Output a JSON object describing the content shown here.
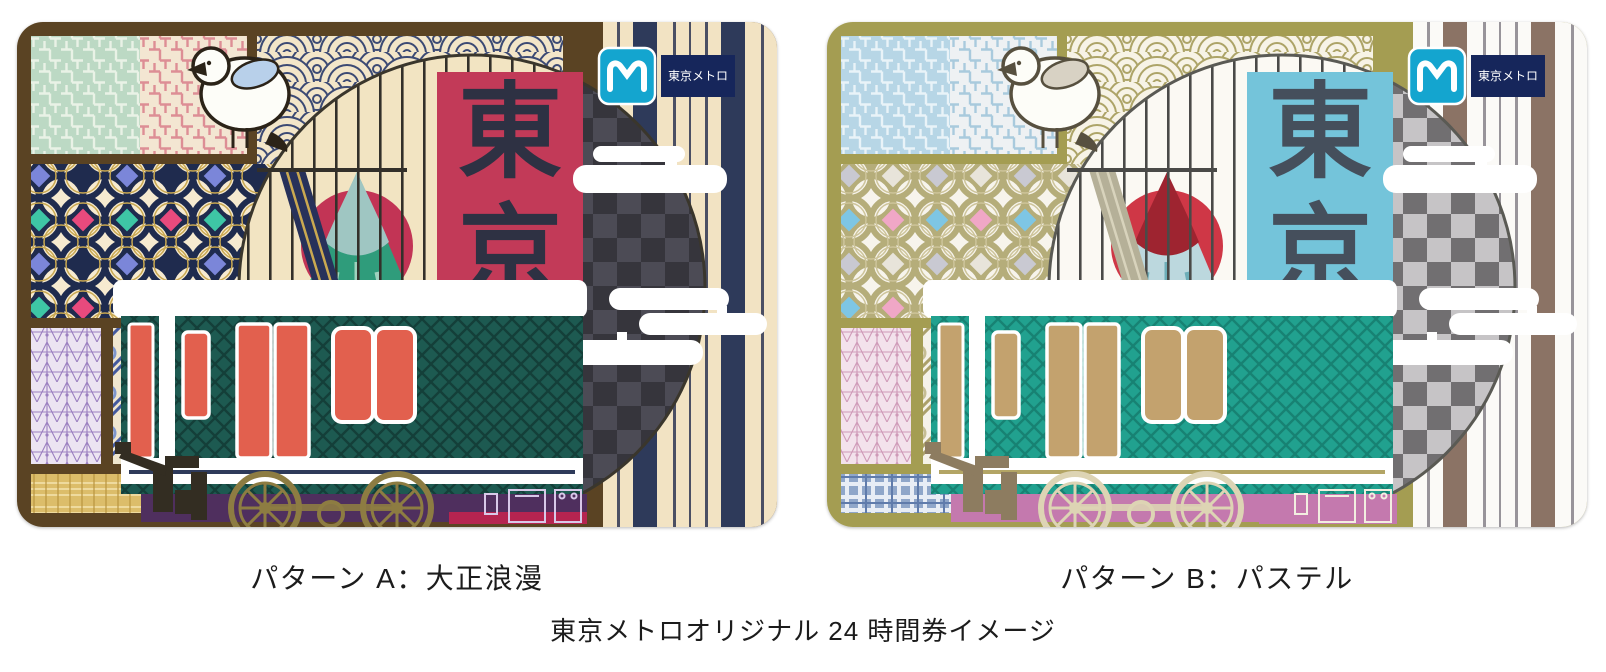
{
  "footer_caption": "東京メトロオリジナル 24 時間券イメージ",
  "cards": [
    {
      "caption": "パターン A：大正浪漫",
      "vertical_label_chars": [
        "東",
        "京"
      ],
      "logo_text": "東京メトロ",
      "palette": {
        "frame": "#5a4323",
        "saya_bg": "#bcd9c4",
        "saya_fg": "#e9f2e6",
        "saya_bg2": "#f3e6d2",
        "saya_fg2": "#dd8e95",
        "wave_bg": "#f3e6c9",
        "wave_fg": "#3c4a74",
        "shippo_bg": "#f6ead0",
        "shippo_ring": "#1f2b4e",
        "shippo_gold": "#c9a851",
        "sh_d1": "#3ec6a5",
        "sh_d2": "#e84a7d",
        "sh_d3": "#7b86d9",
        "sh_d4": "#1f2b4e",
        "asa_bg": "#ece4f2",
        "asa_fg": "#9b7fc0",
        "p2_bg": "#efe6cf",
        "p2_fg": "#43599e",
        "p2_fg2": "#7d95cc",
        "p4_bg": "#dcbd6a",
        "p4_fg": "#eeda9e",
        "p4_dark": "#b9953f",
        "stripe_bg": "#f2e3c3",
        "stripe_a": "#2e3a5a",
        "stripe_b": "#4b4f63",
        "scene_bg": "#f2e4c2",
        "lattice": "#33302a",
        "circle_edge": "#3a362c",
        "check_a": "#36353c",
        "check_b": "#4c4b55",
        "sun": "#c23455",
        "fuji_body": "#2f9c7b",
        "fuji_cap": "#9fc6c2",
        "fuji_streak": "#c5e4d4",
        "panel": "#c23a58",
        "panel_text": "#2e3143",
        "cloud": "#ffffff",
        "train_body": "#1d5a51",
        "train_body2": "#143f39",
        "door": "#e2604e",
        "pinline": "#2e3a5a",
        "under": "#4f2f5e",
        "wheel": "#8d7c42",
        "boxline": "#d8c8e8",
        "accent2": "#b52450",
        "equip": "#332d22",
        "bird_line": "#2b2318",
        "bird_wing": "#b8d0ea",
        "bird_body": "#fdfdf8",
        "logo_cyan": "#14a5cf",
        "logo_navy": "#16265b",
        "beam": "#27315a",
        "beam2": "#c9a851"
      }
    },
    {
      "caption": "パターン B：パステル",
      "vertical_label_chars": [
        "東",
        "京"
      ],
      "logo_text": "東京メトロ",
      "palette": {
        "frame": "#a49d52",
        "saya_bg": "#b7d6e6",
        "saya_fg": "#e9f3f8",
        "saya_bg2": "#eef1f3",
        "saya_fg2": "#a9cadd",
        "wave_bg": "#f7f3e6",
        "wave_fg": "#ada468",
        "shippo_bg": "#f7f4ec",
        "shippo_ring": "#b5ad7a",
        "shippo_gold": "#cdc49a",
        "sh_d1": "#7ec6e4",
        "sh_d2": "#f0a7c6",
        "sh_d3": "#c9c9d2",
        "sh_d4": "#e8e4da",
        "asa_bg": "#f3e2ec",
        "asa_fg": "#cf9ab8",
        "p2_bg": "#f5f2e8",
        "p2_fg": "#aba06a",
        "p2_fg2": "#c5bd92",
        "p4_bg": "#8fa6c9",
        "p4_fg": "#e8edf5",
        "p4_dark": "#5f7bab",
        "stripe_bg": "#fbfaf7",
        "stripe_a": "#8b7365",
        "stripe_b": "#98949a",
        "scene_bg": "#fbf9f3",
        "lattice": "#4a4a48",
        "circle_edge": "#5a5a54",
        "check_a": "#716f71",
        "check_b": "#c6c4c6",
        "sun": "#cf3746",
        "fuji_body": "#bcd8de",
        "fuji_cap": "#9e2430",
        "fuji_streak": "#55a0ac",
        "panel": "#74c4da",
        "panel_text": "#454f5c",
        "cloud": "#ffffff",
        "train_body": "#21a18f",
        "train_body2": "#178273",
        "door": "#c3a26e",
        "pinline": "#b3a565",
        "under": "#c479ae",
        "wheel": "#ddd4b4",
        "boxline": "#f2eee0",
        "accent2": "#c479ae",
        "equip": "#8d7c60",
        "bird_line": "#57503f",
        "bird_wing": "#d8d2c4",
        "bird_body": "#fdfdf8",
        "logo_cyan": "#14a5cf",
        "logo_navy": "#16265b",
        "beam": "#b5b098",
        "beam2": "#d8d3bc"
      }
    }
  ]
}
